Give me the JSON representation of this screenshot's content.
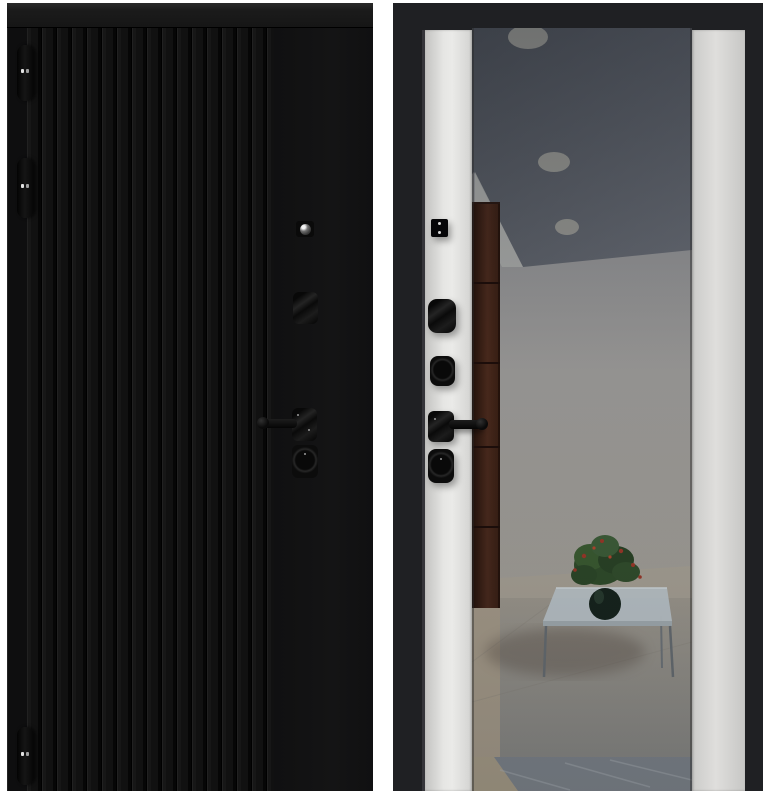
{
  "scene": {
    "background_color": "#ffffff",
    "kind": "entry-door-product-photo-front-and-back"
  },
  "left_door": {
    "aria_label": "door exterior panel, black vertical slats",
    "base_color": "#131313",
    "slat_color": "#171717",
    "hinges": {
      "count": 3,
      "pin_color": "#e2e2e2"
    },
    "hardware_items": [
      "cylinder-peephole",
      "upper-lock-escutcheon",
      "lever-handle",
      "lower-lock-escutcheon"
    ]
  },
  "right_door": {
    "aria_label": "door interior panel with mirror insert",
    "frame_color": "#1f2023",
    "panel_color": "#e0e0de",
    "hardware_items": [
      "latch-plate",
      "upper-thumbturn",
      "lower-thumbturn",
      "lever-handle",
      "lock-escutcheon"
    ]
  },
  "mirror_reflection": {
    "ceiling_light_count": 3,
    "colors": {
      "ceiling": "#5c6067",
      "wall": "#9e9f9c",
      "corner_highlight": "#b4b5b1",
      "cabinet": "#44261a",
      "floor_upper": "#a29c91",
      "floor_lower": "#878d93",
      "table_glass": "#c9d3d7",
      "plant_foliage": "#3a582f",
      "plant_flowers": "#a63a28",
      "vase": "#17251c"
    }
  }
}
